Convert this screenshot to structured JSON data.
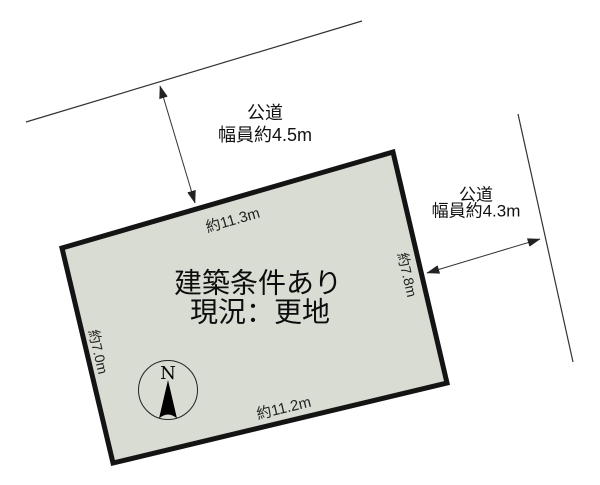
{
  "diagram": {
    "title_hint": "land plot layout drawing",
    "road_top": {
      "name": "公道",
      "width": "幅員約4.5m"
    },
    "road_right": {
      "name": "公道",
      "width": "幅員約4.3m"
    },
    "dimensions": {
      "top": "約11.3m",
      "right": "約7.8m",
      "left": "約7.0m",
      "bottom": "約11.2m"
    },
    "plot": {
      "line1": "建築条件あり",
      "line2": "現況：更地"
    },
    "compass": {
      "north_label": "N"
    },
    "colors": {
      "plot_fill": "#d9dcd3",
      "plot_border": "#141414",
      "line": "#333333"
    }
  }
}
